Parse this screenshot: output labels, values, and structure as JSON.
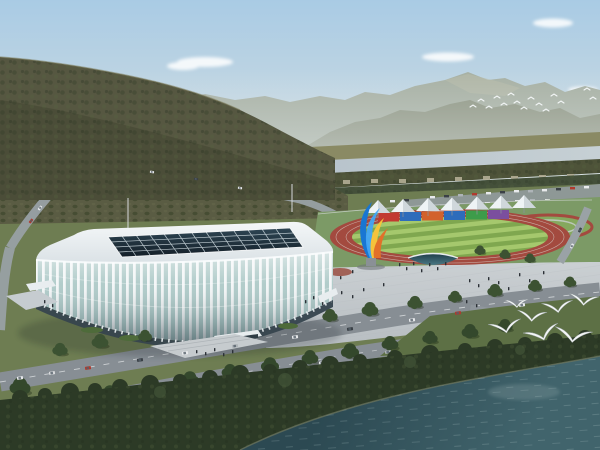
{
  "scene": {
    "type": "architectural-rendering-aerial",
    "description": "Aerial rendering of a white lattice-facade gymnasium beside an outdoor athletics track with a row of white peaked canopy tents, a blue-and-orange ribbon sculpture on a plaza, tree-lined roads with cars, a river and forested mountains behind, and white egrets flying over dark shoreline trees and teal water in the foreground.",
    "landmarks": {
      "gymnasium": "white ribbed building with dark glass skylight roof",
      "athletics_track": "red running track with striped green infield",
      "canopy_row": "white peaked tents over colored panels",
      "sculpture": "twisted ribbon sculpture in blue, yellow and orange",
      "river": "pale river crossing behind the complex",
      "foreground_water": "dark teal water with ripples",
      "birds": "white egrets in flight"
    },
    "counts": {
      "canopy_tents": 7,
      "colored_panels": 6,
      "foreground_birds": 7,
      "distant_birds": 15
    },
    "panel_colors": [
      "#c23a31",
      "#2e6cbb",
      "#d2622c",
      "#2e6cbb",
      "#3d9c4a",
      "#7b4f9e"
    ]
  },
  "colors": {
    "sky_top": "#a9cbe4",
    "sky_mid": "#c6d8e2",
    "sky_horizon": "#e2e7e5",
    "cloud": "#ffffff",
    "haze": "#e3eaec",
    "mountain_far": "#a7b0a3",
    "mountain_mid": "#8e9582",
    "hill": "#565741",
    "hill_shadow": "#474834",
    "orchard": "#5a5c43",
    "bank_fields": "#8a8a64",
    "river_left": "#b6c2ca",
    "river_right": "#c6d0d4",
    "bank_trees": "#4e5339",
    "bank_buildings": "#b3ae96",
    "mid_trees": "#44503a",
    "parking": "#8e9896",
    "lawn": "#7c9a66",
    "track": "#a34a3f",
    "infield_light": "#a5c86d",
    "infield_dark": "#7fa74f",
    "tent": "#eef3f5",
    "tent_shade": "#c9d1d6",
    "sculpture_blue": "#1976d2",
    "sculpture_lightblue": "#42a5f5",
    "sculpture_yellow": "#f5c33b",
    "sculpture_orange": "#e2702a",
    "pedestal": "#8a9096",
    "roof_light": "#f4f7f8",
    "roof_dark": "#dbe2e6",
    "skylight_top": "#2e4654",
    "skylight_bottom": "#141f28",
    "mullion": "#c8d4da",
    "rib": "#f3f6f7",
    "glass": "#aecac8",
    "base_glass": "#36454e",
    "plaza_light": "#cdd2d5",
    "plaza_dark": "#b7bdc1",
    "pool_dark": "#1f3d49",
    "pool_light": "#4a7884",
    "road": "#878e94",
    "road_dash": "#d8dcde",
    "ground": "#6e7d52",
    "slope": "#5d7045",
    "tree": "#3c5232",
    "tree_dark": "#34482c",
    "tree_light": "#46583a",
    "shore_trees": "#2c3a26",
    "water_deep": "#2c4952",
    "water_light": "#41646c",
    "ripple": "#a7bec0",
    "shoreline": "#6e7660",
    "bird": "#f4f6f6",
    "people": "#2b3036",
    "bus": "#d8dbdd"
  }
}
